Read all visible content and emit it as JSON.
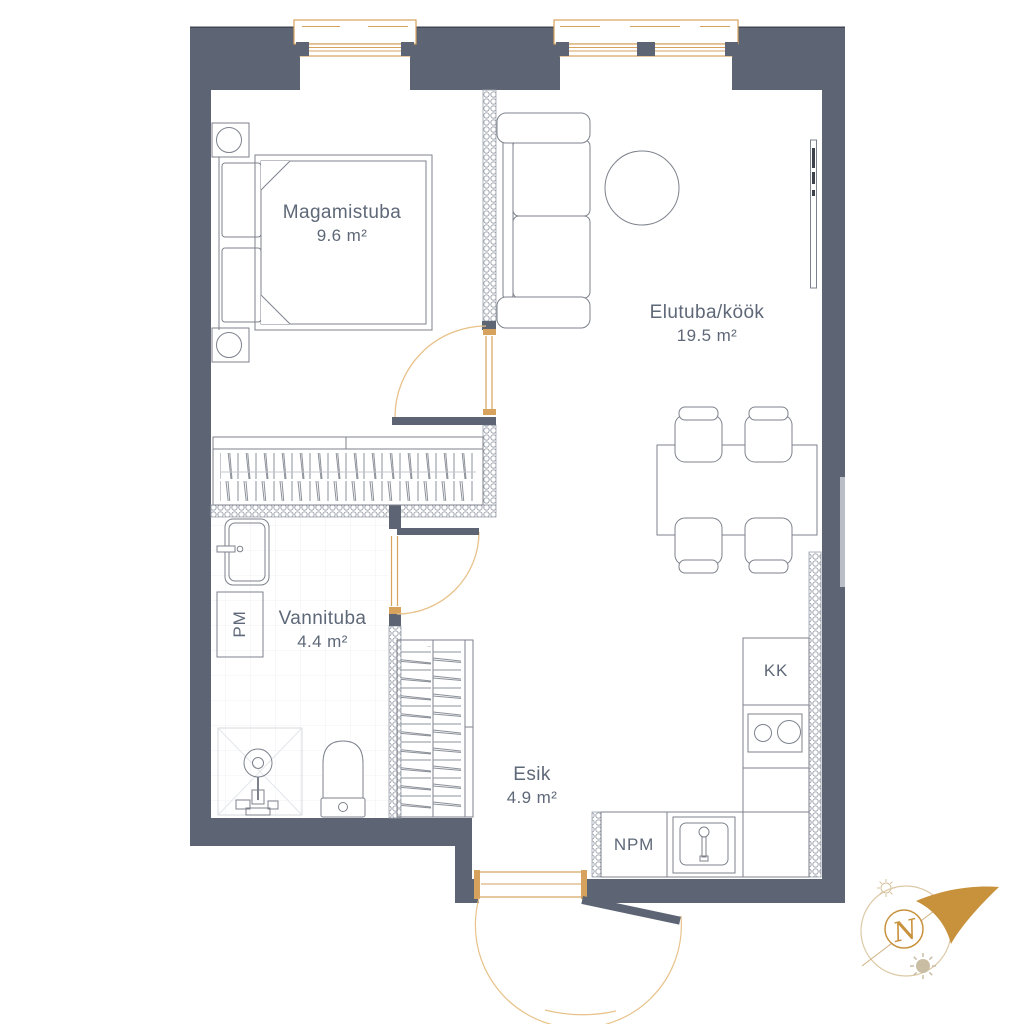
{
  "rooms": {
    "bedroom": {
      "name": "Magamistuba",
      "area": "9.6 m²"
    },
    "living": {
      "name": "Elutuba/köök",
      "area": "19.5 m²"
    },
    "bathroom": {
      "name": "Vannituba",
      "area": "4.4 m²"
    },
    "hallway": {
      "name": "Esik",
      "area": "4.9 m²"
    }
  },
  "appliances": {
    "washing_machine": "PM",
    "fridge": "KK",
    "dishwasher": "NPM"
  },
  "compass": {
    "north_label": "N"
  },
  "colors": {
    "wall": "#5d6474",
    "label_text": "#5e6878",
    "window_frame": "#d6a25d",
    "door_arc": "#e8c28a",
    "compass_gold": "#c8913c",
    "furniture_line": "#7d828c"
  }
}
